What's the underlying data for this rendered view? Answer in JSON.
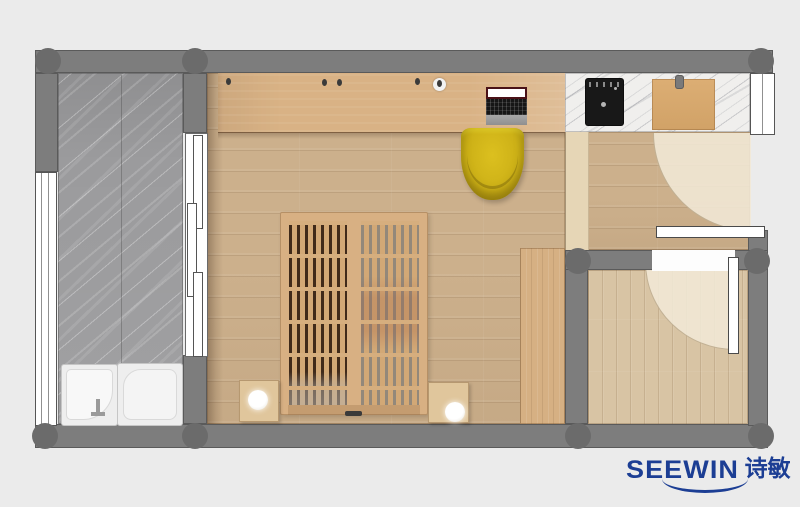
{
  "watermark": {
    "brand_latin": "SEEWIN",
    "brand_cn": "诗敏",
    "color": "#1c3e94"
  },
  "plan": {
    "type": "apartment-floor-plan-top-view",
    "background": "#ebebeb",
    "wall_color": "#7d7d7d",
    "column_color": "#6b6b6b",
    "rooms": [
      {
        "name": "bathroom",
        "floor": "gray-marble",
        "fixtures": [
          "walk-in-tub",
          "shower-tray",
          "sliding-door",
          "window"
        ]
      },
      {
        "name": "main-room",
        "floor": "light-oak-plank",
        "furniture": [
          "wardrobe-desk-counter",
          "laptop",
          "yellow-desk-chair",
          "slatted-platform-bed",
          "nightstand-left",
          "nightstand-right",
          "table-lamp-left",
          "table-lamp-right",
          "side-cabinet"
        ]
      },
      {
        "name": "kitchenette",
        "counter": "white-marble",
        "appliances": [
          "black-cooktop",
          "wooden-cutting-board"
        ],
        "window": true
      },
      {
        "name": "entry-hall",
        "floor": "light-oak-plank",
        "door": "hinged-entry-door-with-swing-arc"
      },
      {
        "name": "side-room",
        "floor": "light-oak-plank-vertical",
        "door": "hinged-door-with-swing-arc"
      }
    ],
    "colors": {
      "wood_floor": "#ccb08c",
      "wood_cabinet": "#d9b285",
      "bath_marble": "#9b9b9d",
      "counter_marble": "#f0efed",
      "chair_yellow": "#cdb117",
      "cooktop_black": "#181818",
      "room2_floor": "#d8c4a4",
      "door_swing": "#f1e8d6",
      "fixture_white": "#eeeeee"
    }
  }
}
